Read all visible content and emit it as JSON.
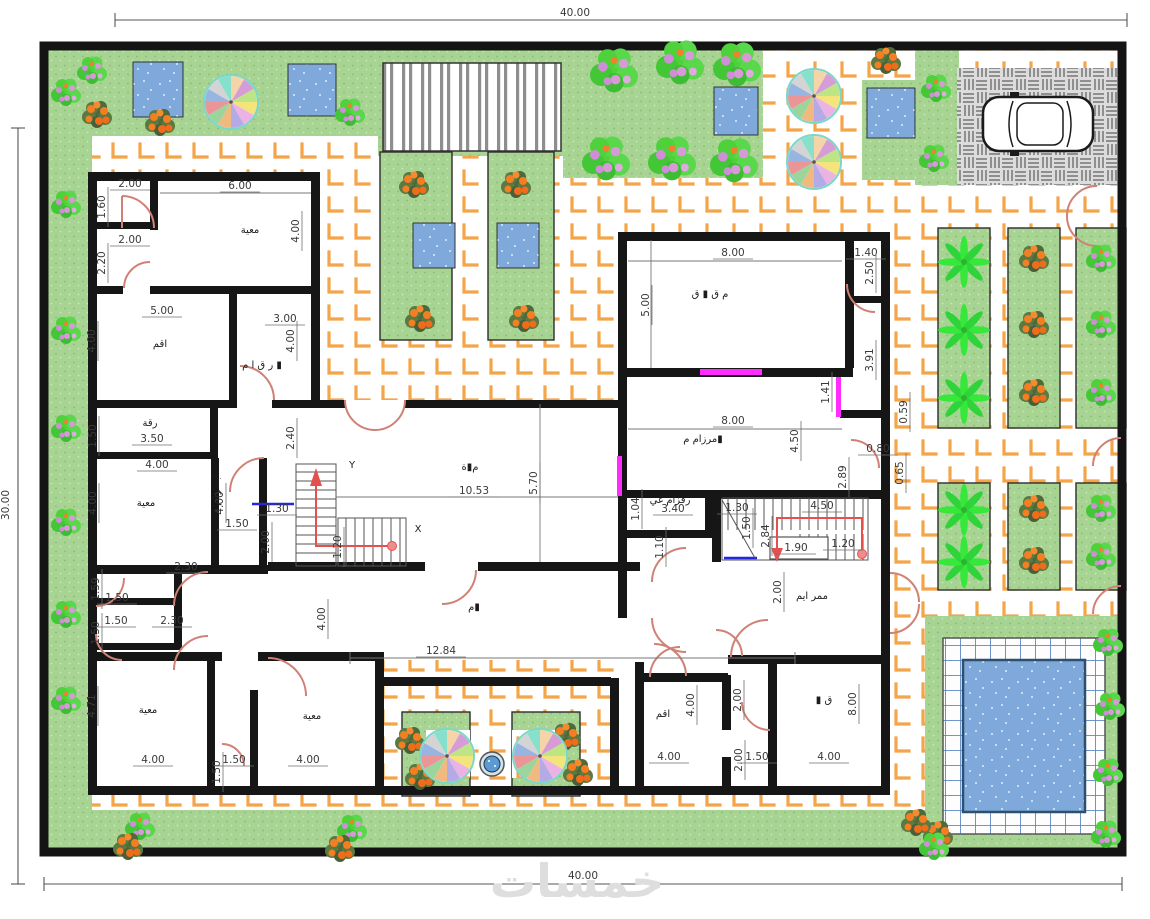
{
  "site": {
    "top_width_label": "40.00",
    "bottom_width_label": "40.00",
    "left_height_label": "30.00"
  },
  "watermark": {
    "text": "خمسات"
  },
  "colors": {
    "wall": "#161616",
    "paving_line": "#f4a547",
    "grass": "#a7d492",
    "water": "#7ea9da",
    "pool_tile_line": "#5d88c4",
    "parking": "#dcdcdc",
    "door_arc": "#d08176",
    "window_magenta": "#ff2bff",
    "stair_arrow_red": "#e4504e",
    "dim_text": "#3a3a3a",
    "watermark_gray": "#dedede"
  },
  "dim_labels": [
    {
      "t": "40.00",
      "x": 575,
      "y": 16,
      "nl": 1
    },
    {
      "t": "40.00",
      "x": 583,
      "y": 879,
      "nl": 1
    },
    {
      "t": "30.00",
      "x": 9,
      "y": 505,
      "r": -90,
      "nl": 1
    },
    {
      "t": "2.00",
      "x": 130,
      "y": 187
    },
    {
      "t": "1.60",
      "x": 105,
      "y": 207,
      "r": -90
    },
    {
      "t": "2.00",
      "x": 130,
      "y": 243
    },
    {
      "t": "2.20",
      "x": 105,
      "y": 263,
      "r": -90
    },
    {
      "t": "6.00",
      "x": 240,
      "y": 189
    },
    {
      "t": "4.00",
      "x": 299,
      "y": 231,
      "r": -90
    },
    {
      "t": "5.00",
      "x": 162,
      "y": 314
    },
    {
      "t": "4.00",
      "x": 95,
      "y": 341,
      "r": -90
    },
    {
      "t": "3.00",
      "x": 285,
      "y": 322
    },
    {
      "t": "4.00",
      "x": 294,
      "y": 341,
      "r": -90
    },
    {
      "t": "1.50",
      "x": 96,
      "y": 436,
      "r": -90
    },
    {
      "t": "3.50",
      "x": 152,
      "y": 442
    },
    {
      "t": "4.00",
      "x": 157,
      "y": 468
    },
    {
      "t": "4.00",
      "x": 96,
      "y": 503,
      "r": -90
    },
    {
      "t": "4.00",
      "x": 223,
      "y": 503,
      "r": -90
    },
    {
      "t": "1.50",
      "x": 237,
      "y": 527
    },
    {
      "t": "1.30",
      "x": 277,
      "y": 512
    },
    {
      "t": "2.00",
      "x": 269,
      "y": 542,
      "r": -90
    },
    {
      "t": "2.40",
      "x": 294,
      "y": 438,
      "r": -90
    },
    {
      "t": "10.53",
      "x": 474,
      "y": 494
    },
    {
      "t": "5.70",
      "x": 537,
      "y": 483,
      "r": -90
    },
    {
      "t": "1.20",
      "x": 341,
      "y": 547,
      "r": -90
    },
    {
      "t": "1.59",
      "x": 99,
      "y": 589,
      "r": -90
    },
    {
      "t": "1.50",
      "x": 117,
      "y": 601
    },
    {
      "t": "1.50",
      "x": 99,
      "y": 633,
      "r": -90
    },
    {
      "t": "1.50",
      "x": 116,
      "y": 624
    },
    {
      "t": "2.30",
      "x": 172,
      "y": 624
    },
    {
      "t": "2.30",
      "x": 186,
      "y": 570
    },
    {
      "t": "4.00",
      "x": 325,
      "y": 619,
      "r": -90
    },
    {
      "t": "4.71",
      "x": 95,
      "y": 706,
      "r": -90
    },
    {
      "t": "4.00",
      "x": 153,
      "y": 763
    },
    {
      "t": "1.50",
      "x": 220,
      "y": 772,
      "r": -90
    },
    {
      "t": "1.50",
      "x": 234,
      "y": 763
    },
    {
      "t": "4.00",
      "x": 308,
      "y": 763
    },
    {
      "t": "12.84",
      "x": 441,
      "y": 654
    },
    {
      "t": "8.00",
      "x": 733,
      "y": 256
    },
    {
      "t": "5.00",
      "x": 649,
      "y": 305,
      "r": -90
    },
    {
      "t": "1.40",
      "x": 866,
      "y": 256
    },
    {
      "t": "2.50",
      "x": 873,
      "y": 273,
      "r": -90
    },
    {
      "t": "3.91",
      "x": 873,
      "y": 360,
      "r": -90
    },
    {
      "t": "1.41",
      "x": 829,
      "y": 392,
      "r": -90
    },
    {
      "t": "8.00",
      "x": 733,
      "y": 424
    },
    {
      "t": "4.50",
      "x": 798,
      "y": 441,
      "r": -90
    },
    {
      "t": "2.89",
      "x": 846,
      "y": 477,
      "r": -90
    },
    {
      "t": "0.80",
      "x": 878,
      "y": 452
    },
    {
      "t": "0.59",
      "x": 907,
      "y": 412,
      "r": -90
    },
    {
      "t": "0.65",
      "x": 903,
      "y": 473,
      "r": -90
    },
    {
      "t": "1.04",
      "x": 639,
      "y": 509,
      "r": -90
    },
    {
      "t": "3.40",
      "x": 673,
      "y": 512
    },
    {
      "t": "1.10",
      "x": 663,
      "y": 547,
      "r": -90
    },
    {
      "t": "1.30",
      "x": 737,
      "y": 511
    },
    {
      "t": "1.50",
      "x": 750,
      "y": 528,
      "r": -90
    },
    {
      "t": "2.84",
      "x": 769,
      "y": 536,
      "r": -90
    },
    {
      "t": "4.50",
      "x": 822,
      "y": 509
    },
    {
      "t": "1.90",
      "x": 796,
      "y": 551
    },
    {
      "t": "1.20",
      "x": 843,
      "y": 547
    },
    {
      "t": "2.00",
      "x": 781,
      "y": 592,
      "r": -90
    },
    {
      "t": "2.00",
      "x": 741,
      "y": 700,
      "r": -90
    },
    {
      "t": "4.00",
      "x": 694,
      "y": 705,
      "r": -90
    },
    {
      "t": "4.00",
      "x": 669,
      "y": 760
    },
    {
      "t": "2.00",
      "x": 742,
      "y": 760,
      "r": -90
    },
    {
      "t": "1.50",
      "x": 757,
      "y": 760
    },
    {
      "t": "4.00",
      "x": 829,
      "y": 760
    },
    {
      "t": "8.00",
      "x": 856,
      "y": 704,
      "r": -90
    }
  ],
  "room_labels": [
    {
      "t": "معية",
      "x": 250,
      "y": 233
    },
    {
      "t": "اقم",
      "x": 160,
      "y": 347
    },
    {
      "t": "ر ق ا م ▮",
      "x": 262,
      "y": 368,
      "s": 9
    },
    {
      "t": "رقة",
      "x": 150,
      "y": 426
    },
    {
      "t": "معية",
      "x": 146,
      "y": 506
    },
    {
      "t": "ابسرقم",
      "x": 219,
      "y": 490,
      "r": -90,
      "s": 8.5
    },
    {
      "t": "م▮ة",
      "x": 470,
      "y": 470
    },
    {
      "t": "Y",
      "x": 352,
      "y": 468,
      "s": 17
    },
    {
      "t": "X",
      "x": 418,
      "y": 532,
      "s": 17
    },
    {
      "t": "م▮",
      "x": 474,
      "y": 610
    },
    {
      "t": "م ق ▮ ق",
      "x": 710,
      "y": 297
    },
    {
      "t": "مرزام م▮",
      "x": 703,
      "y": 442,
      "s": 9
    },
    {
      "t": "رقزام غي",
      "x": 670,
      "y": 503,
      "s": 8
    },
    {
      "t": "ممر ايم",
      "x": 812,
      "y": 599,
      "s": 9
    },
    {
      "t": "اقم",
      "x": 663,
      "y": 717
    },
    {
      "t": "▮ ق",
      "x": 824,
      "y": 703
    },
    {
      "t": "معية",
      "x": 148,
      "y": 713
    },
    {
      "t": "معية",
      "x": 312,
      "y": 719
    }
  ]
}
